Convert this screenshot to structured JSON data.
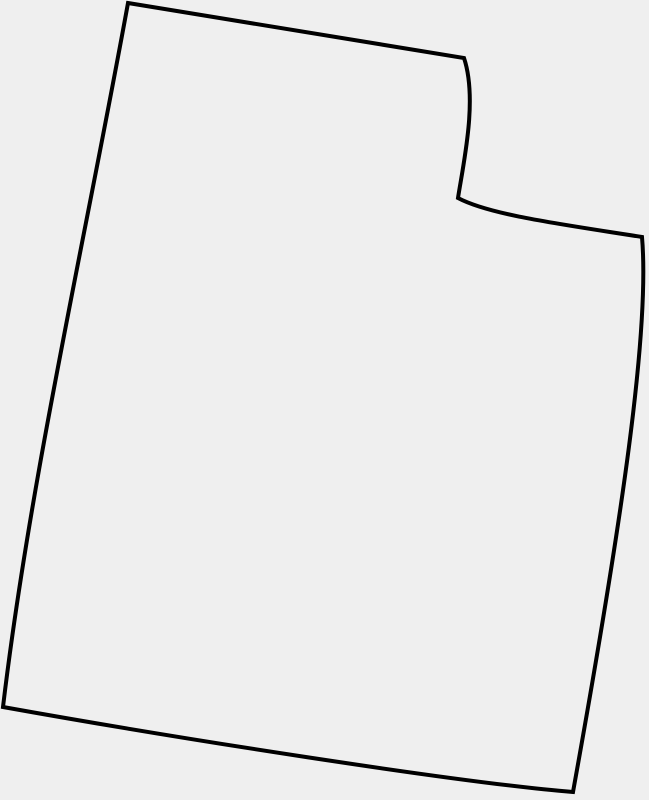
{
  "canvas": {
    "width": 649,
    "height": 800,
    "background_color": "#efefef"
  },
  "map": {
    "region_name": "Utah state border outline",
    "type": "outline-map",
    "stroke_color": "#000000",
    "stroke_width": 4,
    "fill_color": "none",
    "viewbox": "0 0 649 800",
    "path": "M 128,3 L 464,58 C 478,100 463,165 458,198 C 490,215 560,224 642,237 C 650,330 622,520 573,792 C 460,783 170,737 3,707 C 30,480 85,240 128,3 Z",
    "key_points": [
      {
        "label": "northwest-corner",
        "x": 128,
        "y": 3
      },
      {
        "label": "notch-top-corner",
        "x": 464,
        "y": 58
      },
      {
        "label": "notch-inner-corner",
        "x": 458,
        "y": 198
      },
      {
        "label": "northeast-corner",
        "x": 642,
        "y": 237
      },
      {
        "label": "southeast-corner",
        "x": 573,
        "y": 792
      },
      {
        "label": "southwest-corner",
        "x": 3,
        "y": 707
      }
    ]
  }
}
